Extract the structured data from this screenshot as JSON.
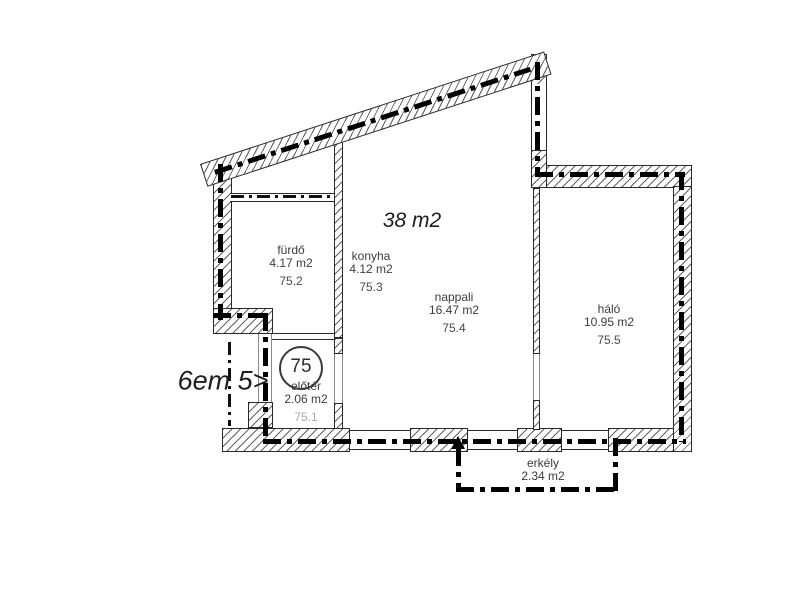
{
  "plan": {
    "title_area": "38 m2",
    "floor_note": "6em 5>",
    "unit_badge": "75",
    "rooms": {
      "furdo": {
        "name": "fürdő",
        "area": "4.17 m2",
        "code": "75.2"
      },
      "konyha": {
        "name": "konyha",
        "area": "4.12 m2",
        "code": "75.3"
      },
      "nappali": {
        "name": "nappali",
        "area": "16.47 m2",
        "code": "75.4"
      },
      "halo": {
        "name": "háló",
        "area": "10.95 m2",
        "code": "75.5"
      },
      "eloter": {
        "name": "előtér",
        "area": "2.06 m2",
        "code": "75.1"
      },
      "erkely": {
        "name": "erkély",
        "area": "2.34 m2"
      }
    },
    "colors": {
      "background": "#ffffff",
      "wall_line": "#2a2a2a",
      "axis_line": "#000000",
      "text": "#3c3c3c",
      "muted_code": "#a9a9a9"
    }
  }
}
